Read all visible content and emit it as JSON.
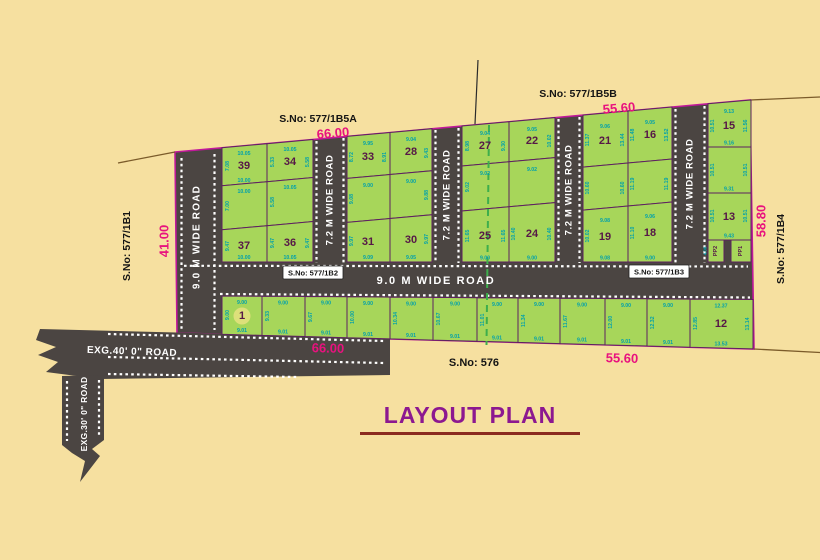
{
  "title": "LAYOUT PLAN",
  "boundary_labels": {
    "top_left_sno": "S.No: 577/1B5A",
    "top_left_dim": "66.00",
    "top_right_sno": "S.No: 577/1B5B",
    "top_right_dim": "55.60",
    "left_sno": "S.No: 577/1B1",
    "left_dim": "41.00",
    "right_sno": "S.No: 577/1B4",
    "right_dim": "58.80",
    "bottom_left_dim": "66.00",
    "bottom_sno": "S.No: 576",
    "bottom_right_dim": "55.60"
  },
  "roads": {
    "left_vertical": "9.0 M WIDE ROAD",
    "internal_72": [
      "7.2 M WIDE ROAD",
      "7.2 M WIDE ROAD",
      "7.2 M WIDE ROAD",
      "7.2 M WIDE ROAD"
    ],
    "horizontal": "9.0 M WIDE ROAD",
    "badge_left": "S.No: 577/1B2",
    "badge_right": "S.No: 577/1B3",
    "exg40": "EXG.40' 0\" ROAD",
    "exg30": "EXG.30' 0\" ROAD"
  },
  "blocks": [
    {
      "cells": [
        {
          "n": "39",
          "t": "10.05",
          "l": "7.08",
          "b": "10.00"
        },
        {
          "n": "34",
          "t": "10.05",
          "l": "5.33",
          "r": "5.58"
        },
        {
          "n": "",
          "t": "10.00",
          "l": "7.00"
        },
        {
          "n": "",
          "t": "10.05",
          "l": "5.58"
        },
        {
          "n": "37",
          "l": "9.47",
          "b": "10.00"
        },
        {
          "n": "36",
          "l": "9.47",
          "r": "9.47",
          "b": "10.05"
        }
      ]
    },
    {
      "cells": [
        {
          "n": "33",
          "t": "9.95",
          "l": "8.72",
          "r": "8.91"
        },
        {
          "n": "28",
          "t": "9.04",
          "r": "9.43"
        },
        {
          "n": "",
          "t": "9.00",
          "l": "9.08"
        },
        {
          "n": "",
          "t": "9.00",
          "r": "9.88"
        },
        {
          "n": "31",
          "l": "9.97",
          "b": "9.09"
        },
        {
          "n": "30",
          "r": "9.97",
          "b": "9.05"
        }
      ]
    },
    {
      "cells": [
        {
          "n": "27",
          "t": "9.04",
          "l": "8.98",
          "r": "9.30"
        },
        {
          "n": "22",
          "t": "9.05",
          "r": "10.02"
        },
        {
          "n": "",
          "t": "9.02",
          "l": "9.02"
        },
        {
          "n": "",
          "t": "9.02"
        },
        {
          "n": "25",
          "l": "11.65",
          "r": "11.65",
          "b": "9.00"
        },
        {
          "n": "24",
          "l": "10.40",
          "r": "10.40",
          "b": "9.00"
        }
      ]
    },
    {
      "cells": [
        {
          "n": "21",
          "t": "9.06",
          "l": "11.37",
          "r": "13.44"
        },
        {
          "n": "16",
          "t": "9.05",
          "l": "11.48",
          "r": "13.52"
        },
        {
          "n": "",
          "l": "10.60",
          "r": "10.60"
        },
        {
          "n": "",
          "l": "11.19",
          "r": "11.19"
        },
        {
          "n": "19",
          "t": "9.08",
          "l": "10.02",
          "b": "9.08"
        },
        {
          "n": "18",
          "t": "9.06",
          "l": "11.10",
          "b": "9.00"
        }
      ]
    },
    {
      "cells": [
        {
          "n": "15",
          "t": "9.13",
          "l": "10.51",
          "r": "11.56",
          "b": "9.16"
        },
        {
          "n": "",
          "l": "10.51",
          "r": "10.51",
          "b": "9.31"
        },
        {
          "n": "13",
          "l": "10.51",
          "r": "10.51",
          "b": "9.43"
        }
      ]
    }
  ],
  "pp_plots": [
    {
      "n": "PP2",
      "l": "4.00"
    },
    {
      "n": "PP1"
    }
  ],
  "bottom_row": [
    {
      "n": "1",
      "t": "9.00",
      "l": "9.00",
      "b": "9.01"
    },
    {
      "n": "",
      "t": "9.00",
      "l": "9.33",
      "b": "9.01"
    },
    {
      "n": "",
      "t": "9.00",
      "l": "9.67",
      "b": "9.01"
    },
    {
      "n": "",
      "t": "9.00",
      "l": "10.00",
      "b": "9.01"
    },
    {
      "n": "",
      "t": "9.00",
      "l": "10.34",
      "b": "9.01"
    },
    {
      "n": "",
      "t": "9.00",
      "l": "10.67",
      "b": "9.01"
    },
    {
      "n": "",
      "t": "9.00",
      "l": "11.01",
      "b": "9.01"
    },
    {
      "n": "",
      "t": "9.00",
      "l": "11.34",
      "b": "9.01"
    },
    {
      "n": "",
      "t": "9.00",
      "l": "11.67",
      "b": "9.01"
    },
    {
      "n": "",
      "t": "9.00",
      "l": "12.00",
      "b": "9.01"
    },
    {
      "n": "",
      "t": "9.00",
      "l": "12.32",
      "b": "9.01"
    },
    {
      "n": "12",
      "t": "12.37",
      "l": "12.85",
      "r": "13.14",
      "b": "13.53"
    }
  ],
  "colors": {
    "background": "#F6E0A0",
    "road": "#4B4542",
    "plot": "#A7D65A",
    "plot_border": "#5E2160",
    "boundary": "#C0189A",
    "dim_text": "#00A0AC",
    "pink_dim": "#E8127E",
    "plot_number": "#561847",
    "dashed_line": "#3DAE4C",
    "title": "#8C1890"
  }
}
